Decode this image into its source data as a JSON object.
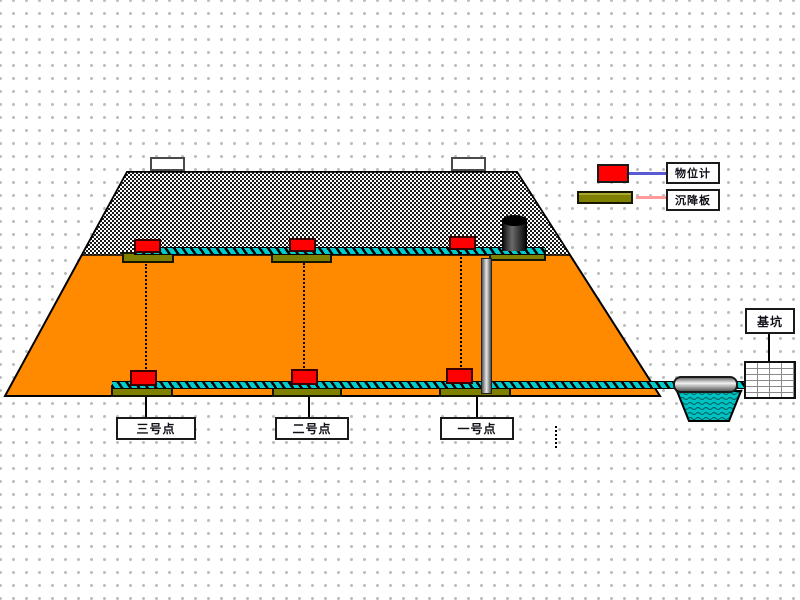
{
  "legend": {
    "items": [
      {
        "icon": "level-gauge-swatch",
        "label": "物位计"
      },
      {
        "icon": "settlement-plate-swatch",
        "label": "沉降板"
      }
    ]
  },
  "points": [
    {
      "label": "三号点"
    },
    {
      "label": "二号点"
    },
    {
      "label": "一号点"
    }
  ],
  "pit": {
    "label": "基坑"
  },
  "colors": {
    "fill_orange": "#FF8A00",
    "rope_teal": "#00CCCC",
    "sensor_red": "#FF0000",
    "plate_olive": "#7F7F00",
    "water_teal": "#00C2C2",
    "legend_line_blue": "#5A5AD2",
    "legend_line_pink": "#FF9A9A",
    "grid_dot": "#BDBDBD"
  }
}
